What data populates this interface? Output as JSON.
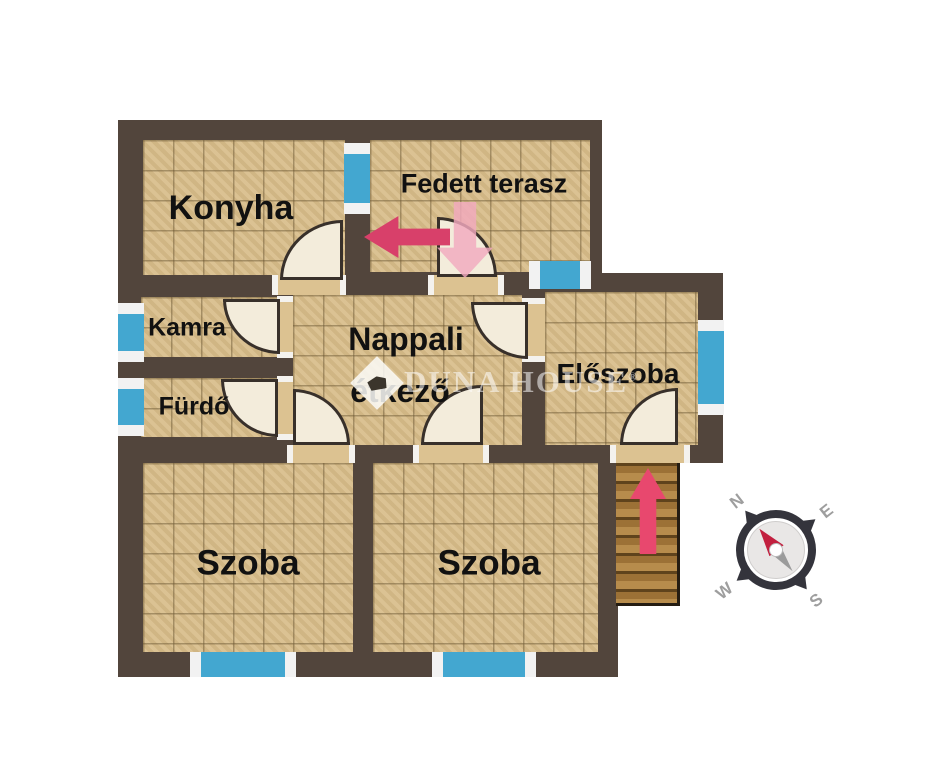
{
  "rooms": {
    "konyha": {
      "label": "Konyha"
    },
    "fedett_terasz": {
      "label": "Fedett terasz"
    },
    "kamra": {
      "label": "Kamra"
    },
    "furdo": {
      "label": "Fürdő"
    },
    "nappali": {
      "label_line1": "Nappali",
      "label_line2": "étkező"
    },
    "eloszoba": {
      "label": "Előszoba"
    },
    "szoba_left": {
      "label": "Szoba"
    },
    "szoba_right": {
      "label": "Szoba"
    }
  },
  "compass": {
    "n": "N",
    "e": "E",
    "s": "S",
    "w": "W"
  },
  "watermark": {
    "text": "DUNA HOUSE",
    "reg": "®"
  },
  "colors": {
    "wall": "#52453c",
    "floor": "#d9be8c",
    "floor-line": "#6e5a36",
    "window": "#43a7d0",
    "door-fill": "#f3ecdb",
    "door-line": "#38302a",
    "arrow-red": "#d8406a",
    "arrow-pink": "#f2aabe",
    "stairs-wood": "#9c7136",
    "label": "#111111"
  }
}
